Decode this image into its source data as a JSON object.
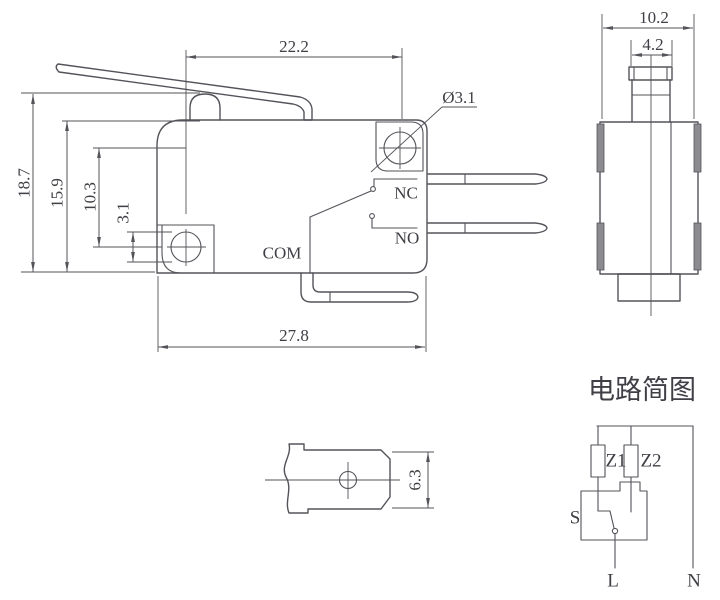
{
  "front": {
    "dim_width_top": "22.2",
    "dim_hole_dia": "Ø3.1",
    "dim_h_total": "18.7",
    "dim_h_body": "15.9",
    "dim_hole_center": "10.3",
    "dim_hole_d": "3.1",
    "dim_width_bottom": "27.8",
    "label_nc": "NC",
    "label_no": "NO",
    "label_com": "COM"
  },
  "side": {
    "dim_width": "10.2",
    "dim_plunger": "4.2"
  },
  "terminal": {
    "dim_height": "6.3"
  },
  "circuit": {
    "title": "电路简图",
    "label_z1": "Z1",
    "label_z2": "Z2",
    "label_s": "S",
    "label_l": "L",
    "label_n": "N"
  },
  "colors": {
    "line": "#53535a",
    "text": "#3f3f46",
    "tab": "#8b8b90",
    "bg": "#ffffff"
  }
}
